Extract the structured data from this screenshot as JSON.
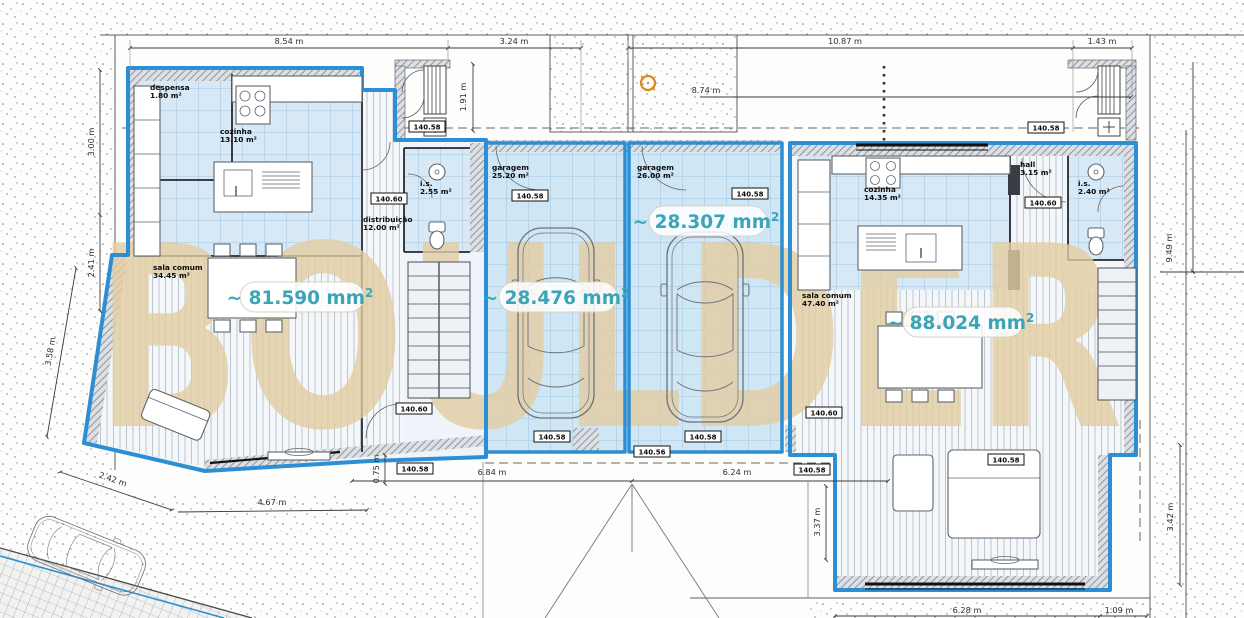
{
  "watermark": "BOULDER",
  "rooms": [
    {
      "name": "despensa",
      "area": "1.80 m²"
    },
    {
      "name": "cozinha",
      "area": "13.10 m²"
    },
    {
      "name": "sala comum",
      "area": "34.45 m²"
    },
    {
      "name": "distribuição",
      "area": "12.00 m²"
    },
    {
      "name": "i.s.",
      "area": "2.55 m²"
    },
    {
      "name": "garagem",
      "area": "25.20 m²"
    },
    {
      "name": "garagem",
      "area": "26.00 m²"
    },
    {
      "name": "cozinha",
      "area": "14.35 m²"
    },
    {
      "name": "hall",
      "area": "3.15 m²"
    },
    {
      "name": "i.s.",
      "area": "2.40 m²"
    },
    {
      "name": "sala comum",
      "area": "47.40 m²"
    }
  ],
  "measurements": [
    {
      "text": "~ 81.590 mm",
      "sup": "2"
    },
    {
      "text": "~ 28.476 mm",
      "sup": "2"
    },
    {
      "text": "~ 28.307 mm",
      "sup": "2"
    },
    {
      "text": "~ 88.024 mm",
      "sup": "2"
    }
  ],
  "levels": [
    "140.58",
    "140.60",
    "140.58",
    "140.58",
    "140.58",
    "140.60",
    "140.60",
    "140.58",
    "140.58",
    "140.58",
    "140.56",
    "140.58",
    "140.60",
    "140.58"
  ],
  "dimensions": [
    "8.54 m",
    "3.24 m",
    "10.87 m",
    "1.43 m",
    "8.74 m",
    "1.91 m",
    "3.00 m",
    "2.41 m",
    "3.58 m",
    "2.42 m",
    "4.67 m",
    "0.75 m",
    "6.84 m",
    "6.24 m",
    "3.37 m",
    "9.49 m",
    "3.42 m",
    "6.28 m",
    "1.09 m"
  ],
  "colors": {
    "outline_blue": "#2d8fd3",
    "room_fill": "#d7e9f6",
    "measurement_teal": "#3ba5b8",
    "watermark_beige": "#e4cda2"
  }
}
